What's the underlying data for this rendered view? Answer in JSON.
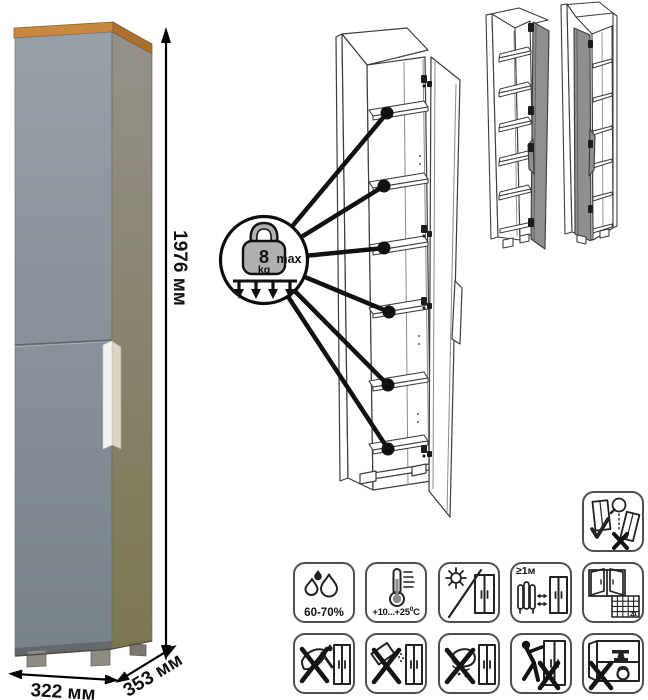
{
  "dimensions": {
    "height": "1976 мм",
    "width": "322 мм",
    "depth": "353 мм"
  },
  "shelf_limit": {
    "weight": "8",
    "unit": "kg",
    "qualifier": "max"
  },
  "icons": {
    "anti_tip": {
      "name": "anti-tip-wall-anchor-icon"
    },
    "row1": [
      {
        "name": "humidity-icon",
        "label": "60-70%"
      },
      {
        "name": "temperature-range-icon",
        "label_main": "+10...+25",
        "label_sup": "0",
        "label_unit": "C"
      },
      {
        "name": "avoid-direct-sunlight-icon"
      },
      {
        "name": "heat-source-distance-icon",
        "label": "≥1м"
      },
      {
        "name": "ventilate-room-icon",
        "calendar_day": "21"
      }
    ],
    "row2": [
      {
        "name": "no-sharp-tools-icon"
      },
      {
        "name": "no-abrasive-cleaners-icon"
      },
      {
        "name": "no-wet-cleaning-icon"
      },
      {
        "name": "no-dragging-icon"
      },
      {
        "name": "no-overload-icon"
      }
    ]
  },
  "colors": {
    "cabinet_front": "#8a939b",
    "cabinet_side": "#8e8a83",
    "cabinet_top_wood": "#c9873f",
    "handle_white": "#f4f2ee",
    "variant_door_gray": "#8f8f8f",
    "lineart": "#3c3c3c"
  }
}
